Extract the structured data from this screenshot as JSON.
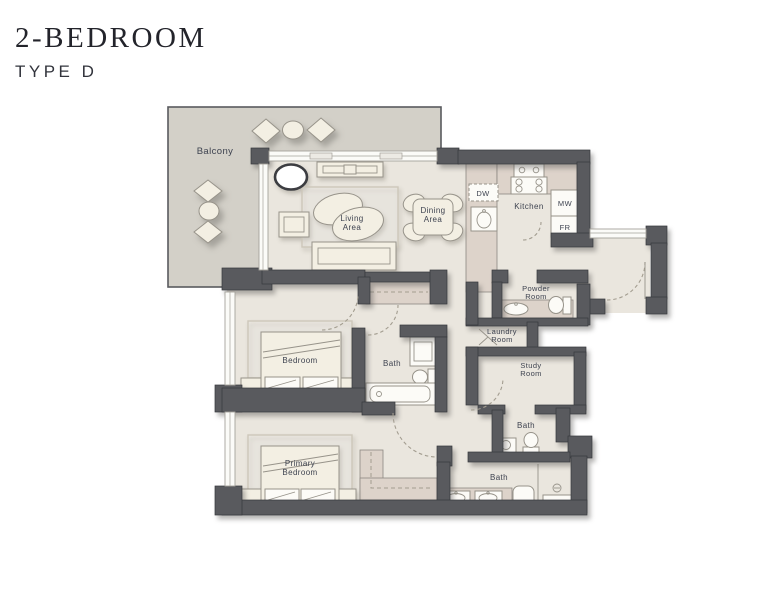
{
  "header": {
    "title": "2-BEDROOM",
    "subtitle": "TYPE D"
  },
  "plan": {
    "balcony": {
      "label": "Balcony"
    },
    "living": {
      "line1": "Living",
      "line2": "Area"
    },
    "dining": {
      "line1": "Dining",
      "line2": "Area"
    },
    "kitchen": {
      "label": "Kitchen",
      "dw": "DW",
      "mw": "MW",
      "fr": "FR"
    },
    "powder": {
      "line1": "Powder",
      "line2": "Room"
    },
    "laundry": {
      "line1": "Laundry",
      "line2": "Room"
    },
    "study": {
      "line1": "Study",
      "line2": "Room"
    },
    "bedroom": {
      "label": "Bedroom"
    },
    "bath_ensuite": {
      "label": "Bath"
    },
    "bath_small": {
      "label": "Bath"
    },
    "bath_primary": {
      "label": "Bath"
    },
    "primary_bedroom": {
      "line1": "Primary",
      "line2": "Bedroom"
    }
  },
  "colors": {
    "title": "#23242b",
    "subtitle": "#32343c",
    "wall": "#595a5e",
    "wall_dark": "#37383c",
    "floor": "#eae6de",
    "balcony_floor": "#d3d0c8",
    "counter": "#ddd3ca",
    "counter_stroke": "#8d8781",
    "furniture": "#f3efe3",
    "furniture_stroke": "#97938a",
    "fixture": "#fcfbf7",
    "rug": "#cdc7ba",
    "glass_stroke": "#a5a29b",
    "dash": "#a39d90",
    "label": "#3e4350"
  }
}
